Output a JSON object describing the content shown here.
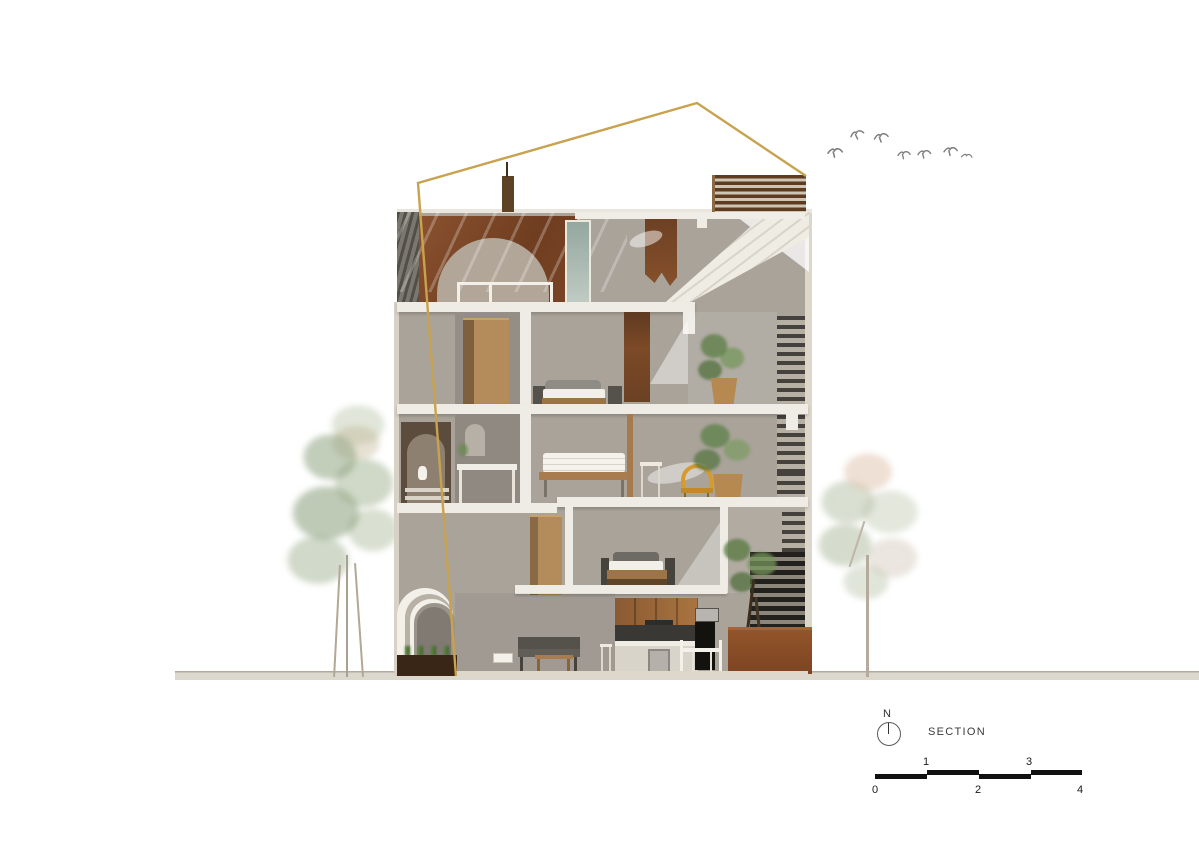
{
  "annotation": {
    "north_label": "N",
    "drawing_title": "SECTION",
    "scale_numbers": [
      "0",
      "1",
      "2",
      "3",
      "4"
    ]
  },
  "colors": {
    "background": "#ffffff",
    "section_cut_line": "#c8a24e",
    "wall_gray": "#a9a39a",
    "slab_white": "#efece5",
    "left_wall_dark": "#6a655e",
    "brick": "#7b4527",
    "corten_steel": "#8c4c24",
    "wood": "#b48c5c",
    "armchair_yellow": "#d79a2f",
    "plant_green": "#6e8a58",
    "glass": "#9cb0a6",
    "ground_band": "#dcd7cd",
    "scale_bar_black": "#111111",
    "annotation_text": "#3b3b3b",
    "bird_gray": "#7d7d7d"
  }
}
